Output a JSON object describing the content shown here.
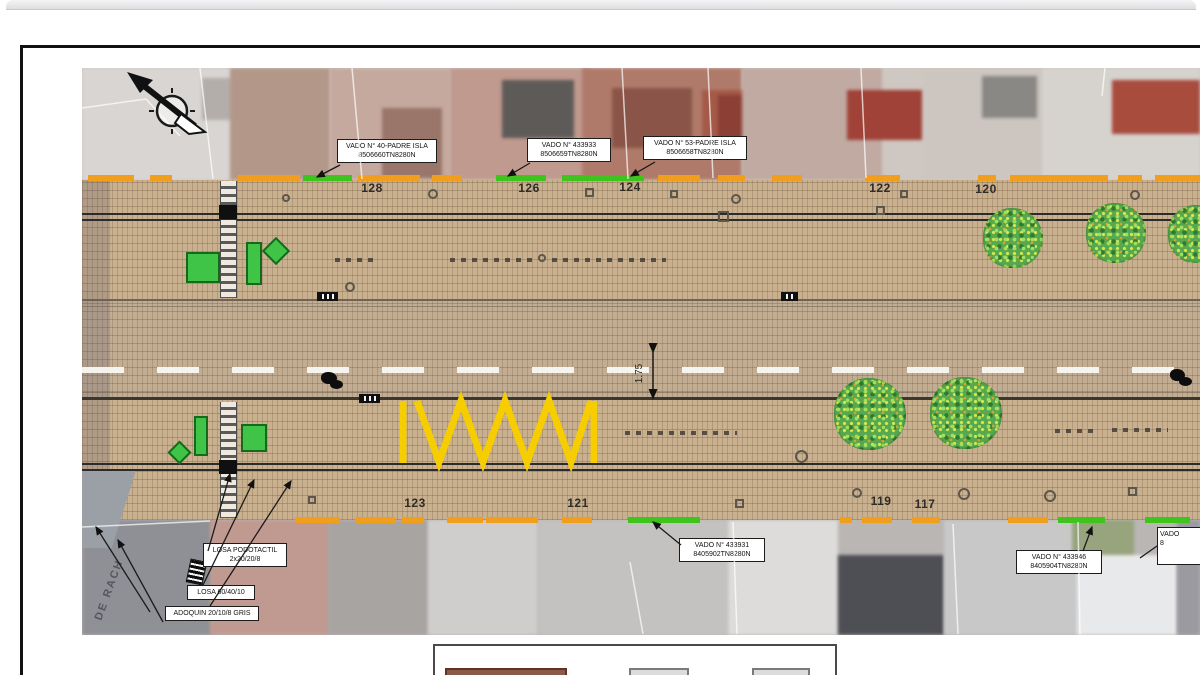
{
  "plan": {
    "house_numbers_top": [
      "128",
      "126",
      "124",
      "122",
      "120"
    ],
    "house_numbers_bottom": [
      "123",
      "121",
      "119",
      "117"
    ],
    "dimension_label": "1.75",
    "street_name_fragment": "DE RACH",
    "callouts": {
      "vado40": {
        "line1": "VADO N° 40-PADRE ISLA",
        "line2": "8506660TN8280N"
      },
      "vado433933": {
        "line1": "VADO N° 433933",
        "line2": "8506659TN8280N"
      },
      "vado53": {
        "line1": "VADO N° 53-PADRE ISLA",
        "line2": "8506658TN8280N"
      },
      "losa_podotactil": {
        "line1": "LOSA PODOTACTIL",
        "line2": "2x20/20/8"
      },
      "losa604010": {
        "line1": "LOSA 60/40/10"
      },
      "adoquin": {
        "line1": "ADOQUIN 20/10/8 GRIS"
      },
      "vado433931": {
        "line1": "VADO N° 433931",
        "line2": "8405902TN8280N"
      },
      "vado433946": {
        "line1": "VADO N° 433946",
        "line2": "8405904TN8280N"
      },
      "vado_cutoff": {
        "line1": "VADO",
        "line2": "8"
      }
    },
    "icons": [
      "north-arrow-icon",
      "tree-icon",
      "podotactile-tile-icon",
      "bollard-strip-icon",
      "parked-bike-icon"
    ],
    "colors": {
      "paving": "#c9b08f",
      "carriageway": "#c2ad93",
      "curb": "#2b2b2b",
      "green": "#3ec41c",
      "orange": "#f09e1c",
      "zigzag": "#f6cd00",
      "furniture": "#3fc447",
      "tree": "#57a84f",
      "center_dash": "#f8f8f4"
    }
  }
}
